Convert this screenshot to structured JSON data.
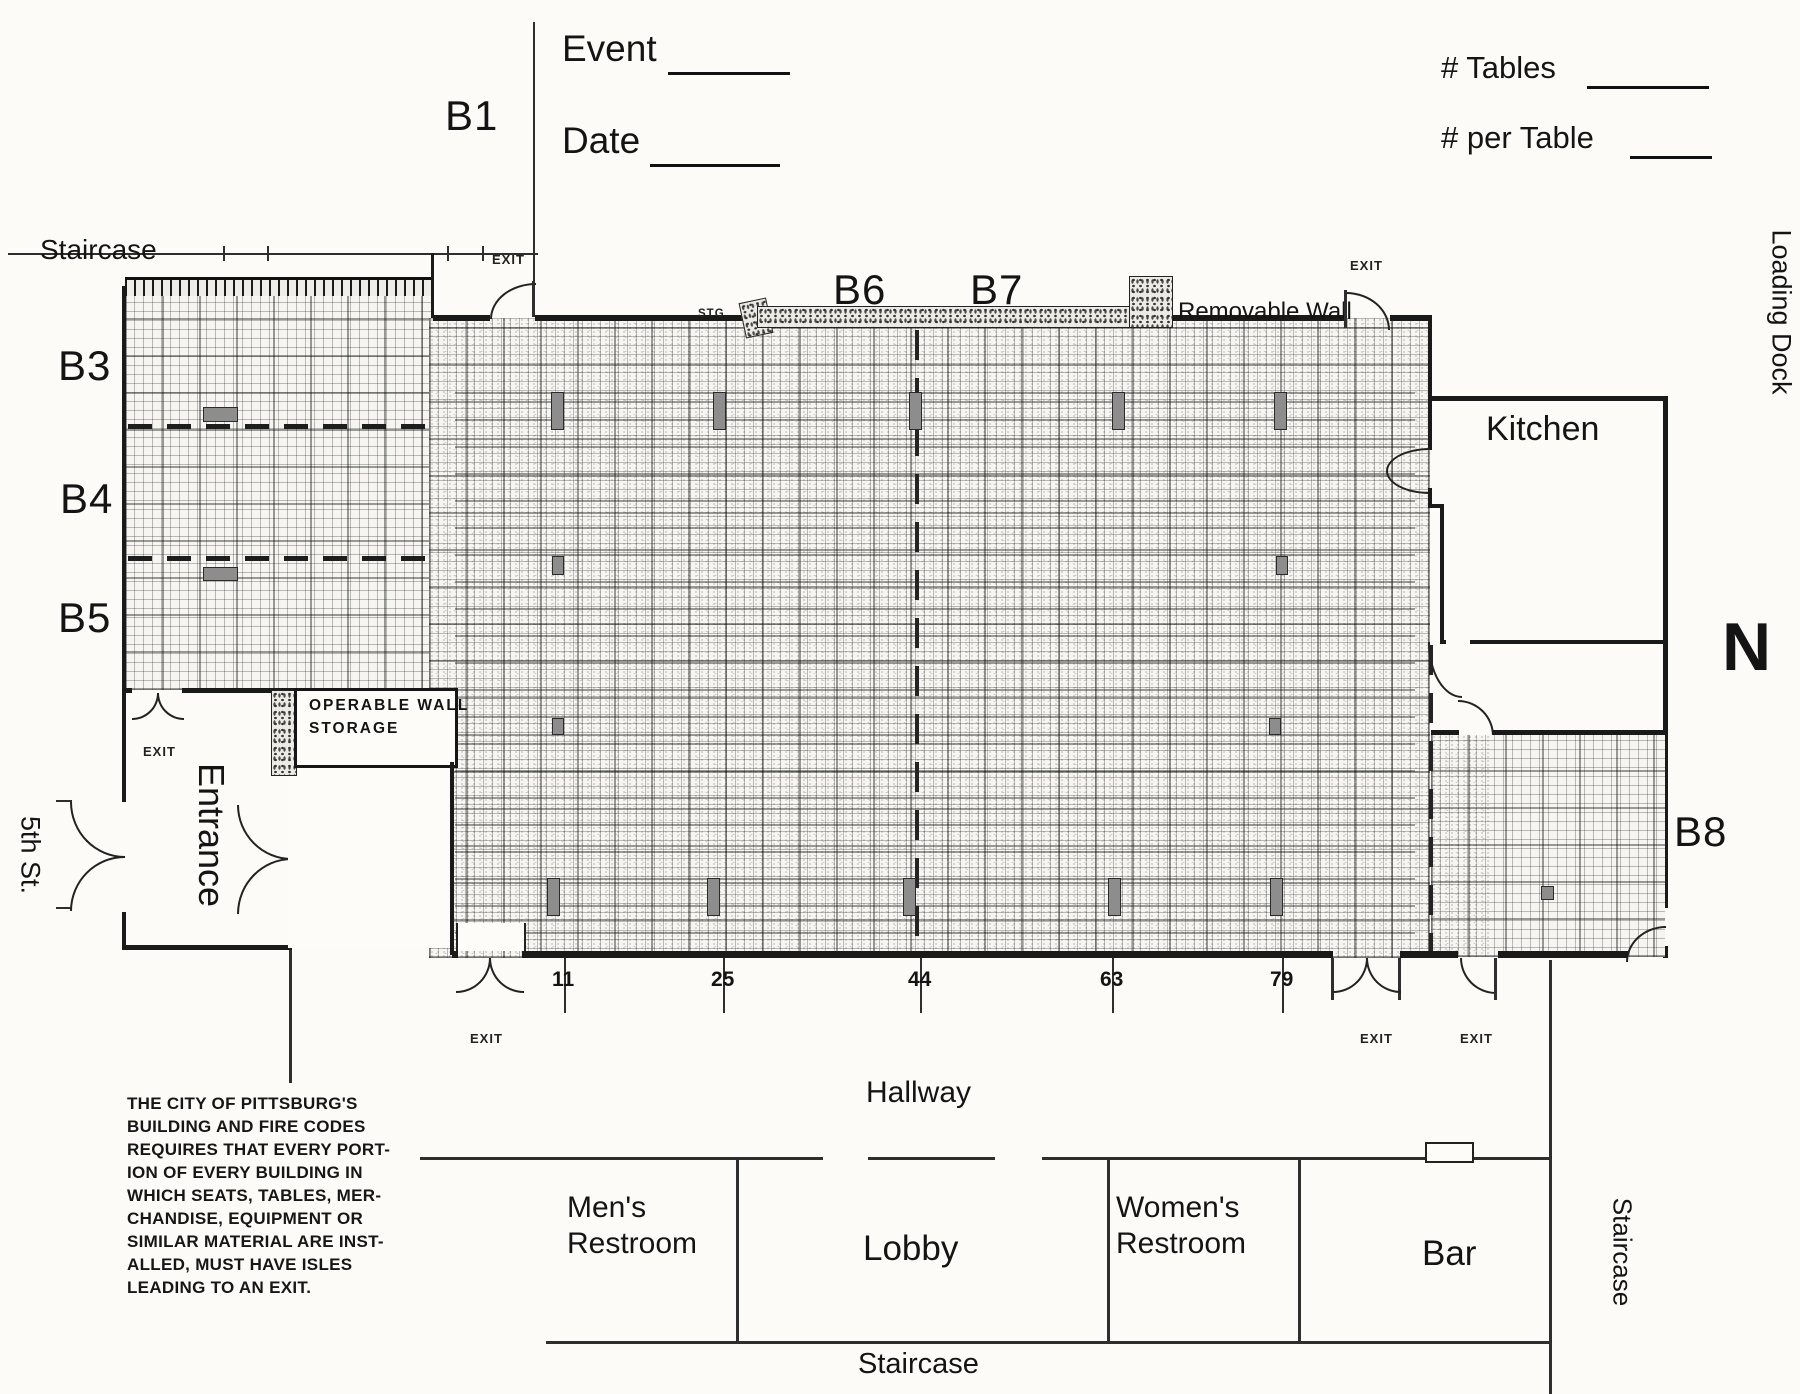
{
  "header": {
    "event_label": "Event",
    "date_label": "Date",
    "num_tables_label": "# Tables",
    "num_per_table_label": "# per Table"
  },
  "compass": {
    "north": "N"
  },
  "outside_labels": {
    "street": "5th St.",
    "loading_dock": "Loading Dock"
  },
  "zone_labels": {
    "b1": "B1",
    "b3": "B3",
    "b4": "B4",
    "b5": "B5",
    "b6": "B6",
    "b7": "B7",
    "b8": "B8"
  },
  "room_labels": {
    "staircase_top": "Staircase",
    "kitchen": "Kitchen",
    "entrance": "Entrance",
    "hallway": "Hallway",
    "mens_line1": "Men's",
    "mens_line2": "Restroom",
    "lobby": "Lobby",
    "womens_line1": "Women's",
    "womens_line2": "Restroom",
    "bar": "Bar",
    "staircase_bottom": "Staircase",
    "staircase_right": "Staircase"
  },
  "wall_labels": {
    "removable_wall": "Removable Wall",
    "storage_line1": "OPERABLE WALL",
    "storage_line2": "STORAGE",
    "stg": "STG."
  },
  "exit_labels": [
    "EXIT",
    "EXIT",
    "EXIT",
    "EXIT",
    "EXIT",
    "EXIT"
  ],
  "table_counts": [
    "11",
    "25",
    "44",
    "63",
    "79"
  ],
  "fire_code_note": {
    "lines": [
      "THE CITY OF PITTSBURG'S",
      "BUILDING AND FIRE CODES",
      "REQUIRES THAT EVERY PORT-",
      "ION OF EVERY BUILDING IN",
      "WHICH SEATS, TABLES, MER-",
      "CHANDISE, EQUIPMENT OR",
      "SIMILAR MATERIAL ARE INST-",
      "ALLED, MUST HAVE ISLES",
      "LEADING TO AN EXIT."
    ]
  },
  "colors": {
    "paper": "#fcfbf8",
    "ink": "#1a1a1a",
    "table_marker_fill": "#8d8d8d"
  }
}
